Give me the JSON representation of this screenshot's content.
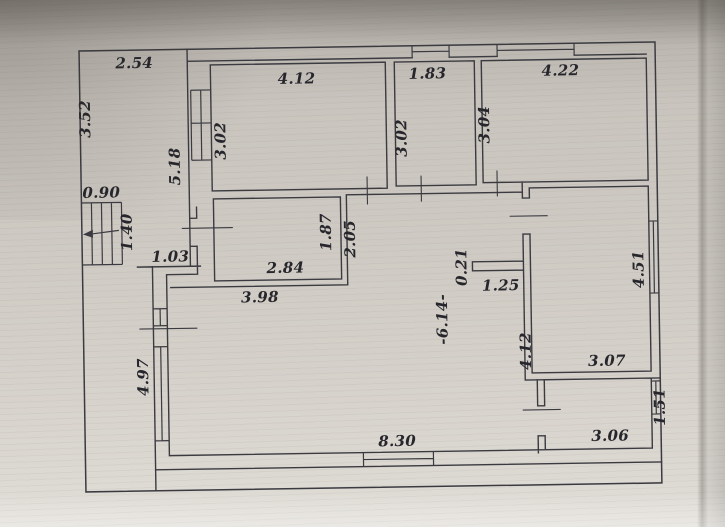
{
  "plan": {
    "style": {
      "line_color": "#3a3a40",
      "paper_color_center": "#cecac3",
      "paper_color_top": "#a5a19a",
      "paper_color_bottom": "#e2dfd9",
      "label_color": "#26262c"
    },
    "dimensions": {
      "terrace": {
        "width": "2.54",
        "depth": "3.52"
      },
      "porch": {
        "width": "0.90",
        "depth": "1.40"
      },
      "left_wall_upper": "5.18",
      "entry_jog": "1.03",
      "left_wall_lower": "4.97",
      "room_top_left": {
        "width": "4.12",
        "depth": "3.02"
      },
      "room_top_middle": {
        "width": "1.83",
        "depth": "3.02"
      },
      "room_top_right": {
        "width": "4.22",
        "depth": "3.04"
      },
      "room_middle": {
        "width": "2.84",
        "depth": "1.87"
      },
      "passage_depth": "2.05",
      "hall_top_width": "3.98",
      "hall_length": "-6.14-",
      "stub_wall": {
        "thickness": "0.21",
        "length": "1.25"
      },
      "room_right": {
        "depth_right": "4.51",
        "depth_left": "4.12",
        "width": "3.07"
      },
      "room_bottom_right": {
        "width": "3.06",
        "depth": "1.51"
      },
      "bottom_wall_width": "8.30"
    }
  }
}
